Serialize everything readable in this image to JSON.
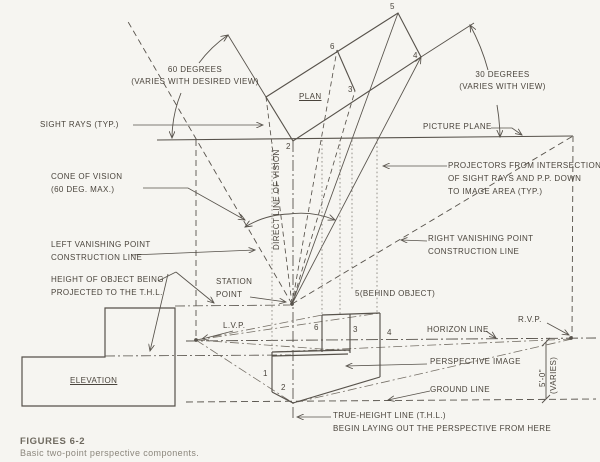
{
  "figure": {
    "title": "FIGURES 6-2",
    "caption": "Basic two-point perspective components."
  },
  "labels": {
    "deg60_1": "60 DEGREES",
    "deg60_2": "(VARIES WITH DESIRED VIEW)",
    "deg30_1": "30 DEGREES",
    "deg30_2": "(VARIES WITH VIEW)",
    "sight_rays": "SIGHT RAYS (TYP.)",
    "picture_plane": "PICTURE PLANE",
    "projectors_1": "PROJECTORS FROM INTERSECTION",
    "projectors_2": "OF SIGHT RAYS AND P.P. DOWN",
    "projectors_3": "TO IMAGE AREA (TYP.)",
    "cone_1": "CONE OF VISION",
    "cone_2": "(60 DEG. MAX.)",
    "lvp_line_1": "LEFT VANISHING POINT",
    "lvp_line_2": "CONSTRUCTION LINE",
    "rvp_line_1": "RIGHT VANISHING POINT",
    "rvp_line_2": "CONSTRUCTION LINE",
    "height_1": "HEIGHT OF OBJECT BEING",
    "height_2": "PROJECTED TO THE T.H.L.",
    "station_1": "STATION",
    "station_2": "POINT",
    "plan": "PLAN",
    "elevation": "ELEVATION",
    "lvp": "L.V.P.",
    "rvp": "R.V.P.",
    "behind": "5(BEHIND OBJECT)",
    "horizon": "HORIZON LINE",
    "perspective_image": "PERSPECTIVE IMAGE",
    "ground": "GROUND LINE",
    "thl_1": "TRUE-HEIGHT LINE (T.H.L.)",
    "thl_2": "BEGIN LAYING OUT THE PERSPECTIVE FROM HERE",
    "direct_line": "DIRECT LINE OF VISION",
    "dim_height": "5'-0\"",
    "dim_varies": "(VARIES)"
  },
  "plan_points": {
    "p5": "5",
    "p6": "6",
    "p4": "4",
    "p3": "3",
    "p2": "2"
  },
  "persp_points": {
    "q6": "6",
    "q3": "3",
    "q4": "4",
    "q1": "1",
    "q2": "2"
  },
  "colors": {
    "ink": "#57524b",
    "light_ink": "#8d8880",
    "paper": "#f6f5f1"
  }
}
